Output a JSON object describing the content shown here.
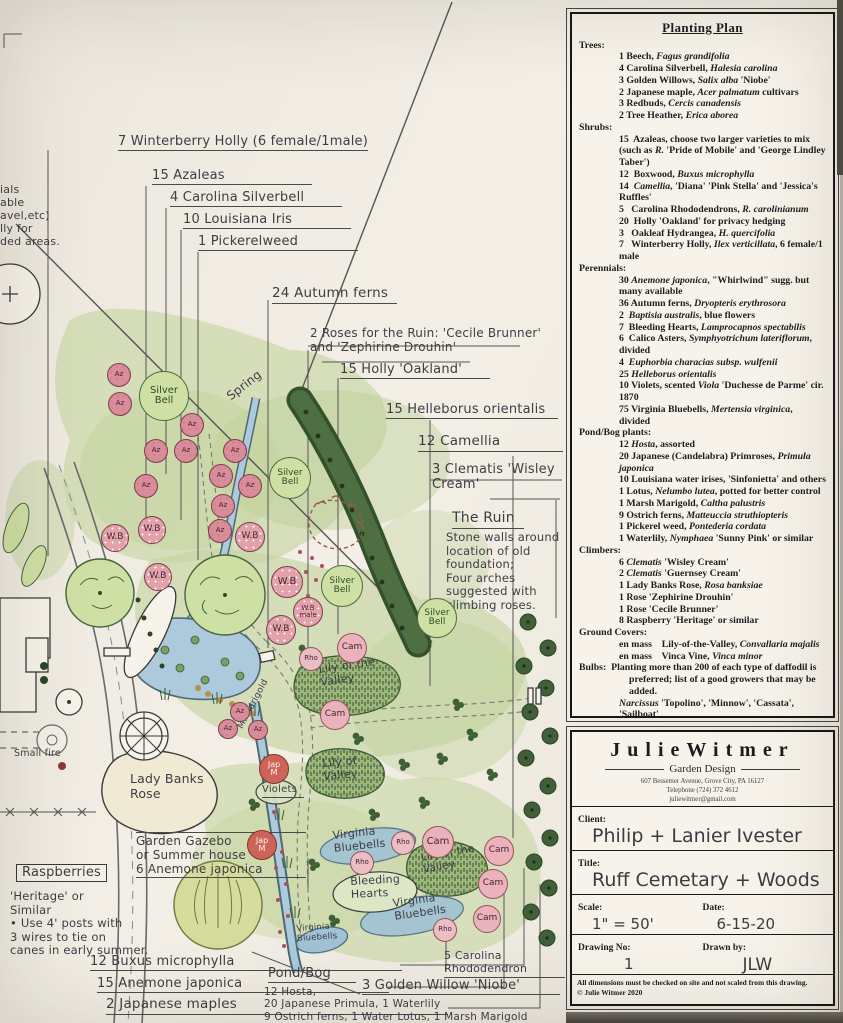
{
  "colors": {
    "paper": "#f2eee5",
    "ink": "#1d1d20",
    "hand_ink": "#3d3d44",
    "wash_green": "#ccd8ab",
    "hedge_green": "#4d6f41",
    "water_blue": "#accadb",
    "azalea_pink": "#d98d9b"
  },
  "planting_plan": {
    "title": "Planting Plan",
    "sections": [
      {
        "title": "Trees:",
        "items": [
          "1 Beech, *Fagus grandifolia*",
          "4 Carolina Silverbell, *Halesia carolina*",
          "3 Golden Willows, *Salix alba* 'Niobe'",
          "2 Japanese maple, *Acer palmatum* cultivars",
          "3 Redbuds, *Cercis canadensis*",
          "2 Tree Heather, *Erica aborea*"
        ]
      },
      {
        "title": "Shrubs:",
        "items": [
          "15  Azaleas, choose two larger varieties to mix (such as *R.* 'Pride of Mobile' and 'George Lindley Taber')",
          "12  Boxwood, *Buxus microphylla*",
          "14  *Camellia*, 'Diana' 'Pink Stella' and 'Jessica's Ruffles'",
          "5   Carolina Rhododendrons, *R. carolinianum*",
          "20  Holly 'Oakland' for privacy hedging",
          "3   Oakleaf Hydrangea, *H. quercifolia*",
          "7   Winterberry Holly, *Ilex verticillata*, 6 female/1 male"
        ]
      },
      {
        "title": "Perennials:",
        "items": [
          "30 *Anemone japonica*, \"Whirlwind\" sugg. but many available",
          "36 Autumn ferns, *Dryopteris erythrosora*",
          "2  *Baptisia australis*, blue flowers",
          "7  Bleeding Hearts, *Lamprocapnos spectabilis*",
          "6  Calico Asters, *Symphyotrichum lateriflorum*, divided",
          "4  *Euphorbia characias subsp. wulfenii*",
          "25 *Helleborus orientalis*",
          "10 Violets, scented *Viola* 'Duchesse de Parme' cir. 1870",
          "75 Virginia Bluebells, *Mertensia virginica*, divided"
        ]
      },
      {
        "title": "Pond/Bog plants:",
        "items": [
          "12 *Hosta*, assorted",
          "20 Japanese (Candelabra) Primroses, *Primula japonica*",
          "10 Louisiana water irises, 'Sinfonietta' and others",
          "1 Lotus, *Nelumbo lutea*, potted for better control",
          "1 Marsh Marigold, *Caltha palustris*",
          "9 Ostrich ferns, *Matteuccia struthiopteris*",
          "1 Pickerel weed, *Pontederia cordata*",
          "1 Waterlily, *Nymphaea* 'Sunny Pink' or similar"
        ]
      },
      {
        "title": "Climbers:",
        "items": [
          "6 *Clematis* 'Wisley Cream'",
          "2 *Clematis* 'Guernsey Cream'",
          "1 Lady Banks Rose, *Rosa banksiae*",
          "1 Rose 'Zephirine Drouhin'",
          "1 Rose 'Cecile Brunner'",
          "8 Raspberry 'Heritage' or similar"
        ]
      },
      {
        "title": "Ground Covers:",
        "items": [
          "en mass    Lily-of-the-Valley, *Convallaria majalis*",
          "en mass    Vinca Vine, *Vinca minor*"
        ]
      },
      {
        "title": "Bulbs:",
        "note": "Planting more than 200 of each type of daffodil is preferred; list of a good growers that may be added.",
        "items": [
          "*Narcissus* 'Topolino', 'Minnow', 'Cassata', 'Sailboat'",
          "*Narcissus* 'Sweet Love', 'Thalia', 'Hawera'",
          "*Narcissus albus plenus odoratus*, circa 1860",
          "10 Martagon lilies, *Lilium martagon*"
        ]
      },
      {
        "title": "Self Sowing annuals:",
        "note": "Add to cemetery grave areas to add color without root damage to stones, etc.",
        "items": [
          "*Cosmos* 'Purity'",
          "*Nigella* 'Bridal Veil'",
          "*Myosotis sylvatica*, Forget-me-nots"
        ]
      }
    ]
  },
  "title_block": {
    "brand": "JulieWitmer",
    "tagline": "Garden Design",
    "address": "607 Bessemer Avenue, Grove City, PA 16127",
    "phone": "Telephone (724) 372 4612",
    "email": "juliewitmer@gmail.com",
    "client_label": "Client:",
    "client": "Philip + Lanier Ivester",
    "title_label": "Title:",
    "title": "Ruff Cemetary + Woods",
    "scale_label": "Scale:",
    "scale": "1\" = 50'",
    "date_label": "Date:",
    "date": "6-15-20",
    "drawing_no_label": "Drawing No:",
    "drawing_no": "1",
    "drawn_by_label": "Drawn by:",
    "drawn_by": "JLW",
    "disclaimer": "All dimensions must be checked on site and not scaled from this drawing.",
    "copyright": "© Julie Witmer 2020"
  },
  "plan": {
    "labels": [
      {
        "n": "callout-winterberry-holly",
        "t": "7 Winterberry Holly (6 female/1male)",
        "x": 118,
        "y": 134,
        "fs": 13,
        "u": 195
      },
      {
        "n": "callout-azaleas",
        "t": "15 Azaleas",
        "x": 152,
        "y": 168,
        "fs": 13,
        "u": 160
      },
      {
        "n": "callout-carolina-silverbell",
        "t": "4  Carolina Silverbell",
        "x": 170,
        "y": 190,
        "fs": 13,
        "u": 172
      },
      {
        "n": "callout-louisiana-iris",
        "t": "10 Louisiana Iris",
        "x": 183,
        "y": 212,
        "fs": 13,
        "u": 168
      },
      {
        "n": "callout-pickerelweed",
        "t": "1 Pickerelweed",
        "x": 198,
        "y": 234,
        "fs": 13,
        "u": 160
      },
      {
        "n": "callout-autumn-ferns",
        "t": "24 Autumn ferns",
        "x": 272,
        "y": 286,
        "fs": 13.5,
        "u": 125
      },
      {
        "n": "callout-roses-ruin",
        "t": "2 Roses for the Ruin: 'Cecile Brunner'\nand 'Zephirine Drouhin'",
        "x": 310,
        "y": 326,
        "fs": 12,
        "u": 0
      },
      {
        "n": "callout-holly-oakland",
        "t": "15 Holly 'Oakland'",
        "x": 340,
        "y": 362,
        "fs": 13,
        "u": 150
      },
      {
        "n": "callout-helleborus",
        "t": "15 Helleborus orientalis",
        "x": 386,
        "y": 402,
        "fs": 13,
        "u": 172
      },
      {
        "n": "callout-camellia",
        "t": "12 Camellia",
        "x": 418,
        "y": 434,
        "fs": 13.5,
        "u": 145
      },
      {
        "n": "callout-clematis",
        "t": "3 Clematis 'Wisley\n        Cream'",
        "x": 432,
        "y": 462,
        "fs": 13,
        "u": 0
      },
      {
        "n": "ruin-heading",
        "t": "The Ruin",
        "x": 452,
        "y": 510,
        "fs": 14,
        "u": 72
      },
      {
        "n": "ruin-note",
        "t": "Stone walls around\nlocation of old\nfoundation;\n Four arches\n   suggested with\n    climbing roses.",
        "x": 446,
        "y": 531,
        "fs": 11.5
      },
      {
        "n": "spring-label",
        "t": "Spring",
        "x": 224,
        "y": 392,
        "fs": 12,
        "r": -38
      },
      {
        "n": "small-fire-label",
        "t": "Small fire",
        "x": 14,
        "y": 748,
        "fs": 9.5
      },
      {
        "n": "edge-note",
        "t": "ials\nable\navel,etc)\nlly for\nded areas.",
        "x": 0,
        "y": 184,
        "fs": 11
      },
      {
        "n": "raspberries-heading",
        "t": "Raspberries",
        "x": 16,
        "y": 864,
        "fs": 13,
        "cls": "box"
      },
      {
        "n": "raspberries-note",
        "t": "'Heritage' or\n Similar\n• Use 4' posts with\n3 wires to tie on\ncanes in early summer.",
        "x": 10,
        "y": 890,
        "fs": 11.5
      },
      {
        "n": "gazebo-note",
        "t": "Garden Gazebo\nor Summer house\n6 Anemone japonica",
        "x": 136,
        "y": 832,
        "fs": 12,
        "u": 170,
        "cls": "ruled"
      },
      {
        "n": "callout-buxus",
        "t": "12 Buxus microphylla",
        "x": 90,
        "y": 954,
        "fs": 13,
        "u": 312
      },
      {
        "n": "callout-anemone",
        "t": "15 Anemone japonica",
        "x": 97,
        "y": 976,
        "fs": 13,
        "u": 292
      },
      {
        "n": "callout-japanese-maples",
        "t": "2 Japanese maples",
        "x": 106,
        "y": 997,
        "fs": 13.5,
        "u": 342
      },
      {
        "n": "pond-bog-heading",
        "t": "Pond/Bog",
        "x": 268,
        "y": 966,
        "fs": 13,
        "u": 88
      },
      {
        "n": "pond-bog-note",
        "t": "12 Hosta,\n20 Japanese Primula, 1 Waterlily\n9 Ostrich ferns, 1 Water Lotus, 1 Marsh Marigold",
        "x": 264,
        "y": 986,
        "fs": 10.5
      },
      {
        "n": "callout-golden-willow",
        "t": "3 Golden Willow 'Niobe'",
        "x": 362,
        "y": 978,
        "fs": 13,
        "u": 198
      },
      {
        "n": "callout-carolina-rhododendron",
        "t": "5 Carolina Rhododendron",
        "x": 444,
        "y": 950,
        "fs": 11,
        "u": 120
      },
      {
        "n": "lady-banks-label",
        "t": "Lady Banks\nRose",
        "x": 130,
        "y": 772,
        "fs": 12.5
      },
      {
        "n": "lily-valley-label-1",
        "t": "Lily of the\n   Valley",
        "x": 318,
        "y": 664,
        "fs": 11,
        "r": -8
      },
      {
        "n": "lily-valley-label-2",
        "t": "Lily of\nValley",
        "x": 322,
        "y": 758,
        "fs": 11,
        "r": -5
      },
      {
        "n": "lily-valley-label-3",
        "t": "Lily of the\n  Valley",
        "x": 420,
        "y": 852,
        "fs": 10.5,
        "r": -10
      },
      {
        "n": "virginia-bluebells-label-1",
        "t": "Virginia\nBluebells",
        "x": 332,
        "y": 830,
        "fs": 11,
        "r": -6
      },
      {
        "n": "bleeding-hearts-label",
        "t": "Bleeding\nHearts",
        "x": 350,
        "y": 876,
        "fs": 11,
        "r": -3
      },
      {
        "n": "virginia-bluebells-label-2",
        "t": "Virginia\nBluebells",
        "x": 392,
        "y": 898,
        "fs": 11,
        "r": -8
      },
      {
        "n": "virginia-bluebells-label-3",
        "t": "Virginia\nBluebells",
        "x": 296,
        "y": 924,
        "fs": 8.5,
        "r": -4
      },
      {
        "n": "violets-label",
        "t": "Violets",
        "x": 262,
        "y": 784,
        "fs": 10,
        "u": 42
      },
      {
        "n": "marsh-marigold-label",
        "t": "M. Marigold",
        "x": 236,
        "y": 726,
        "fs": 9,
        "r": -62
      }
    ],
    "circles": [
      {
        "n": "azalea-symbol",
        "cls": "az",
        "t": "Az",
        "x": 119,
        "y": 375,
        "r": 12
      },
      {
        "n": "azalea-symbol",
        "cls": "az",
        "t": "Az",
        "x": 120,
        "y": 404,
        "r": 12
      },
      {
        "n": "azalea-symbol",
        "cls": "az",
        "t": "Az",
        "x": 192,
        "y": 425,
        "r": 12
      },
      {
        "n": "azalea-symbol",
        "cls": "az",
        "t": "Az",
        "x": 156,
        "y": 451,
        "r": 12
      },
      {
        "n": "azalea-symbol",
        "cls": "az",
        "t": "Az",
        "x": 186,
        "y": 451,
        "r": 12
      },
      {
        "n": "azalea-symbol",
        "cls": "az",
        "t": "Az",
        "x": 235,
        "y": 451,
        "r": 12
      },
      {
        "n": "azalea-symbol",
        "cls": "az",
        "t": "Az",
        "x": 221,
        "y": 476,
        "r": 12
      },
      {
        "n": "azalea-symbol",
        "cls": "az",
        "t": "Az",
        "x": 146,
        "y": 486,
        "r": 12
      },
      {
        "n": "azalea-symbol",
        "cls": "az",
        "t": "Az",
        "x": 250,
        "y": 486,
        "r": 12
      },
      {
        "n": "azalea-symbol",
        "cls": "az",
        "t": "Az",
        "x": 223,
        "y": 506,
        "r": 12
      },
      {
        "n": "azalea-symbol",
        "cls": "az",
        "t": "Az",
        "x": 220,
        "y": 531,
        "r": 12
      },
      {
        "n": "azalea-symbol",
        "cls": "az",
        "t": "Az",
        "x": 240,
        "y": 712,
        "r": 10
      },
      {
        "n": "azalea-symbol",
        "cls": "az",
        "t": "Az",
        "x": 258,
        "y": 730,
        "r": 10
      },
      {
        "n": "azalea-symbol",
        "cls": "az",
        "t": "Az",
        "x": 228,
        "y": 729,
        "r": 10
      },
      {
        "n": "winterberry-symbol",
        "cls": "wb",
        "t": "W.B",
        "x": 115,
        "y": 538,
        "r": 14
      },
      {
        "n": "winterberry-symbol",
        "cls": "wb",
        "t": "W.B",
        "x": 152,
        "y": 530,
        "r": 14
      },
      {
        "n": "winterberry-symbol",
        "cls": "wb",
        "t": "W.B",
        "x": 158,
        "y": 577,
        "r": 14
      },
      {
        "n": "winterberry-symbol",
        "cls": "wb",
        "t": "W.B",
        "x": 250,
        "y": 537,
        "r": 15
      },
      {
        "n": "winterberry-symbol",
        "cls": "wb",
        "t": "W.B",
        "x": 287,
        "y": 582,
        "r": 16
      },
      {
        "n": "winterberry-symbol",
        "cls": "wb",
        "t": "W.B",
        "x": 281,
        "y": 630,
        "r": 15
      },
      {
        "n": "winterberry-male-symbol",
        "cls": "wb",
        "t": "W.B\nmale",
        "x": 308,
        "y": 612,
        "r": 15,
        "fs": 7
      },
      {
        "n": "silverbell-symbol",
        "cls": "sb",
        "t": "Silver\nBell",
        "x": 164,
        "y": 396,
        "r": 25,
        "fs": 10
      },
      {
        "n": "silverbell-symbol",
        "cls": "sb",
        "t": "Silver\nBell",
        "x": 290,
        "y": 478,
        "r": 21,
        "fs": 9
      },
      {
        "n": "silverbell-symbol",
        "cls": "sb",
        "t": "Silver\nBell",
        "x": 342,
        "y": 586,
        "r": 21,
        "fs": 9
      },
      {
        "n": "silverbell-symbol",
        "cls": "sb",
        "t": "Silver\nBell",
        "x": 437,
        "y": 618,
        "r": 20,
        "fs": 9
      },
      {
        "n": "camellia-symbol",
        "cls": "cam",
        "t": "Cam",
        "x": 352,
        "y": 648,
        "r": 15
      },
      {
        "n": "camellia-symbol",
        "cls": "cam",
        "t": "Cam",
        "x": 335,
        "y": 715,
        "r": 15
      },
      {
        "n": "camellia-symbol",
        "cls": "cam",
        "t": "Cam",
        "x": 438,
        "y": 842,
        "r": 16
      },
      {
        "n": "camellia-symbol",
        "cls": "cam",
        "t": "Cam",
        "x": 499,
        "y": 851,
        "r": 15
      },
      {
        "n": "camellia-symbol",
        "cls": "cam",
        "t": "Cam",
        "x": 493,
        "y": 884,
        "r": 15
      },
      {
        "n": "camellia-symbol",
        "cls": "cam",
        "t": "Cam",
        "x": 487,
        "y": 919,
        "r": 14
      },
      {
        "n": "rhododendron-symbol",
        "cls": "rho",
        "t": "Rho",
        "x": 311,
        "y": 659,
        "r": 12
      },
      {
        "n": "rhododendron-symbol",
        "cls": "rho",
        "t": "Rho",
        "x": 403,
        "y": 843,
        "r": 12
      },
      {
        "n": "rhododendron-symbol",
        "cls": "rho",
        "t": "Rho",
        "x": 362,
        "y": 863,
        "r": 12
      },
      {
        "n": "rhododendron-symbol",
        "cls": "rho",
        "t": "Rho",
        "x": 445,
        "y": 930,
        "r": 12
      },
      {
        "n": "japanese-maple-symbol",
        "cls": "jm",
        "t": "Jap\nM",
        "x": 274,
        "y": 769,
        "r": 15,
        "fs": 8
      },
      {
        "n": "japanese-maple-symbol",
        "cls": "jm",
        "t": "Jap\nM",
        "x": 262,
        "y": 845,
        "r": 15,
        "fs": 8
      }
    ]
  }
}
